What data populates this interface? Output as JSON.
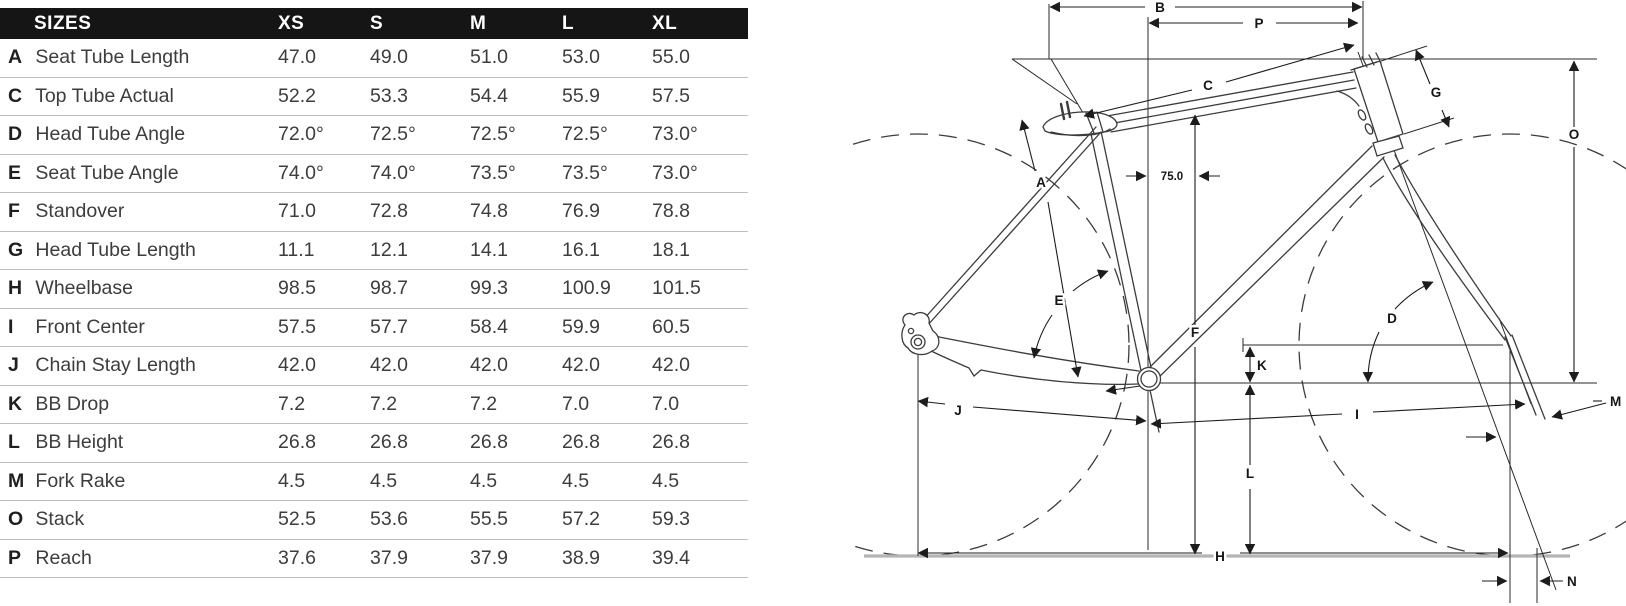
{
  "table": {
    "header": {
      "title": "SIZES",
      "columns": [
        "XS",
        "S",
        "M",
        "L",
        "XL"
      ]
    },
    "rows": [
      {
        "letter": "A",
        "label": "Seat Tube Length",
        "values": [
          "47.0",
          "49.0",
          "51.0",
          "53.0",
          "55.0"
        ]
      },
      {
        "letter": "C",
        "label": "Top Tube Actual",
        "values": [
          "52.2",
          "53.3",
          "54.4",
          "55.9",
          "57.5"
        ]
      },
      {
        "letter": "D",
        "label": "Head Tube Angle",
        "values": [
          "72.0°",
          "72.5°",
          "72.5°",
          "72.5°",
          "73.0°"
        ]
      },
      {
        "letter": "E",
        "label": "Seat Tube Angle",
        "values": [
          "74.0°",
          "74.0°",
          "73.5°",
          "73.5°",
          "73.0°"
        ]
      },
      {
        "letter": "F",
        "label": "Standover",
        "values": [
          "71.0",
          "72.8",
          "74.8",
          "76.9",
          "78.8"
        ]
      },
      {
        "letter": "G",
        "label": "Head Tube Length",
        "values": [
          "11.1",
          "12.1",
          "14.1",
          "16.1",
          "18.1"
        ]
      },
      {
        "letter": "H",
        "label": "Wheelbase",
        "values": [
          "98.5",
          "98.7",
          "99.3",
          "100.9",
          "101.5"
        ]
      },
      {
        "letter": "I",
        "label": "Front Center",
        "values": [
          "57.5",
          "57.7",
          "58.4",
          "59.9",
          "60.5"
        ]
      },
      {
        "letter": "J",
        "label": "Chain Stay Length",
        "values": [
          "42.0",
          "42.0",
          "42.0",
          "42.0",
          "42.0"
        ]
      },
      {
        "letter": "K",
        "label": "BB Drop",
        "values": [
          "7.2",
          "7.2",
          "7.2",
          "7.0",
          "7.0"
        ]
      },
      {
        "letter": "L",
        "label": "BB Height",
        "values": [
          "26.8",
          "26.8",
          "26.8",
          "26.8",
          "26.8"
        ]
      },
      {
        "letter": "M",
        "label": "Fork Rake",
        "values": [
          "4.5",
          "4.5",
          "4.5",
          "4.5",
          "4.5"
        ]
      },
      {
        "letter": "O",
        "label": "Stack",
        "values": [
          "52.5",
          "53.6",
          "55.5",
          "57.2",
          "59.3"
        ]
      },
      {
        "letter": "P",
        "label": "Reach",
        "values": [
          "37.6",
          "37.9",
          "37.9",
          "38.9",
          "39.4"
        ]
      }
    ]
  },
  "diagram": {
    "labels": {
      "a": "A",
      "b": "B",
      "c": "C",
      "d": "D",
      "e": "E",
      "f": "F",
      "g": "G",
      "h": "H",
      "i": "I",
      "j": "J",
      "k": "K",
      "l": "L",
      "m": "M",
      "n": "N",
      "o": "O",
      "p": "P",
      "setback": "75.0"
    }
  },
  "colors": {
    "header_bg": "#151515",
    "header_text": "#ffffff",
    "row_divider": "#bfbfbf",
    "text_primary": "#1f1f1f",
    "text_secondary": "#3d3d3d",
    "frame_line": "#3c3c3c",
    "dim_line": "#1c1c1c",
    "ground_line": "#b5b5b5",
    "page_bg": "#ffffff"
  }
}
